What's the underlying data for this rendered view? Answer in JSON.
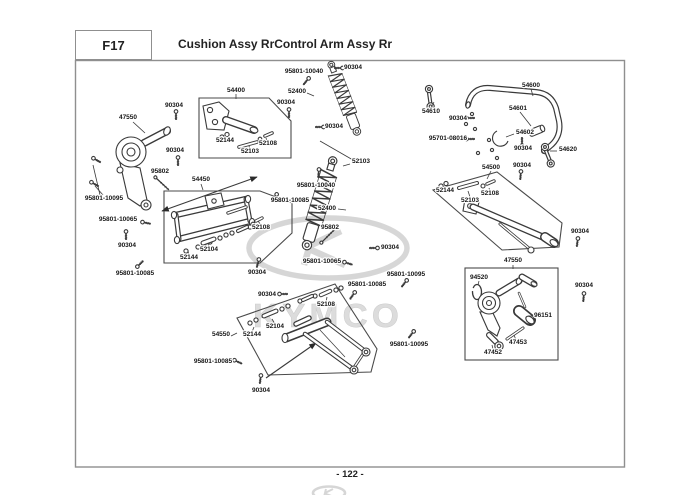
{
  "header": {
    "section_code": "F17",
    "title": "Cushion Assy RrControl Arm Assy Rr"
  },
  "footer": {
    "page_number": "- 122 -"
  },
  "watermark": {
    "text": "KYMCO"
  },
  "colors": {
    "line": "#3a3a3a",
    "frame": "#8f8f8f",
    "watermark": "#cdcdcd",
    "label": "#161616"
  },
  "callouts": [
    {
      "text": "95801-10040",
      "x": 304,
      "y": 73
    },
    {
      "text": "90304",
      "x": 353,
      "y": 69
    },
    {
      "text": "54400",
      "x": 236,
      "y": 92
    },
    {
      "text": "52400",
      "x": 297,
      "y": 93
    },
    {
      "text": "90304",
      "x": 174,
      "y": 107
    },
    {
      "text": "90304",
      "x": 286,
      "y": 104
    },
    {
      "text": "47550",
      "x": 128,
      "y": 119
    },
    {
      "text": "52144",
      "x": 225,
      "y": 142
    },
    {
      "text": "52103",
      "x": 250,
      "y": 153
    },
    {
      "text": "52108",
      "x": 268,
      "y": 145
    },
    {
      "text": "90304",
      "x": 334,
      "y": 128
    },
    {
      "text": "90304",
      "x": 175,
      "y": 152
    },
    {
      "text": "52103",
      "x": 361,
      "y": 163
    },
    {
      "text": "95802",
      "x": 160,
      "y": 173
    },
    {
      "text": "54450",
      "x": 201,
      "y": 181
    },
    {
      "text": "95801-10040",
      "x": 316,
      "y": 187
    },
    {
      "text": "95801-10095",
      "x": 104,
      "y": 200
    },
    {
      "text": "95801-10085",
      "x": 290,
      "y": 202
    },
    {
      "text": "52400",
      "x": 327,
      "y": 210
    },
    {
      "text": "95801-10065",
      "x": 118,
      "y": 221
    },
    {
      "text": "52108",
      "x": 261,
      "y": 229
    },
    {
      "text": "95802",
      "x": 330,
      "y": 229
    },
    {
      "text": "90304",
      "x": 127,
      "y": 247
    },
    {
      "text": "90304",
      "x": 390,
      "y": 249
    },
    {
      "text": "52104",
      "x": 209,
      "y": 251
    },
    {
      "text": "52144",
      "x": 189,
      "y": 259
    },
    {
      "text": "95801-10065",
      "x": 322,
      "y": 263
    },
    {
      "text": "90304",
      "x": 257,
      "y": 274
    },
    {
      "text": "95801-10085",
      "x": 135,
      "y": 275
    },
    {
      "text": "95801-10095",
      "x": 406,
      "y": 276
    },
    {
      "text": "90304",
      "x": 267,
      "y": 296
    },
    {
      "text": "95801-10085",
      "x": 367,
      "y": 286
    },
    {
      "text": "52108",
      "x": 326,
      "y": 306
    },
    {
      "text": "52104",
      "x": 275,
      "y": 328
    },
    {
      "text": "52144",
      "x": 252,
      "y": 336
    },
    {
      "text": "54550",
      "x": 221,
      "y": 336
    },
    {
      "text": "95801-10085",
      "x": 213,
      "y": 363
    },
    {
      "text": "95801-10095",
      "x": 409,
      "y": 346
    },
    {
      "text": "90304",
      "x": 261,
      "y": 392
    },
    {
      "text": "54610",
      "x": 431,
      "y": 113
    },
    {
      "text": "54600",
      "x": 531,
      "y": 87
    },
    {
      "text": "90304",
      "x": 458,
      "y": 120
    },
    {
      "text": "54601",
      "x": 518,
      "y": 110
    },
    {
      "text": "95701-08016",
      "x": 448,
      "y": 140
    },
    {
      "text": "54602",
      "x": 525,
      "y": 134
    },
    {
      "text": "90304",
      "x": 523,
      "y": 150
    },
    {
      "text": "54620",
      "x": 568,
      "y": 151
    },
    {
      "text": "54500",
      "x": 491,
      "y": 169
    },
    {
      "text": "90304",
      "x": 522,
      "y": 167
    },
    {
      "text": "52144",
      "x": 445,
      "y": 192
    },
    {
      "text": "52103",
      "x": 470,
      "y": 202
    },
    {
      "text": "52108",
      "x": 490,
      "y": 195
    },
    {
      "text": "90304",
      "x": 580,
      "y": 233
    },
    {
      "text": "47550",
      "x": 513,
      "y": 262
    },
    {
      "text": "94520",
      "x": 479,
      "y": 279
    },
    {
      "text": "96151",
      "x": 543,
      "y": 317
    },
    {
      "text": "47453",
      "x": 518,
      "y": 344
    },
    {
      "text": "47452",
      "x": 493,
      "y": 354
    },
    {
      "text": "90304",
      "x": 584,
      "y": 287
    }
  ]
}
